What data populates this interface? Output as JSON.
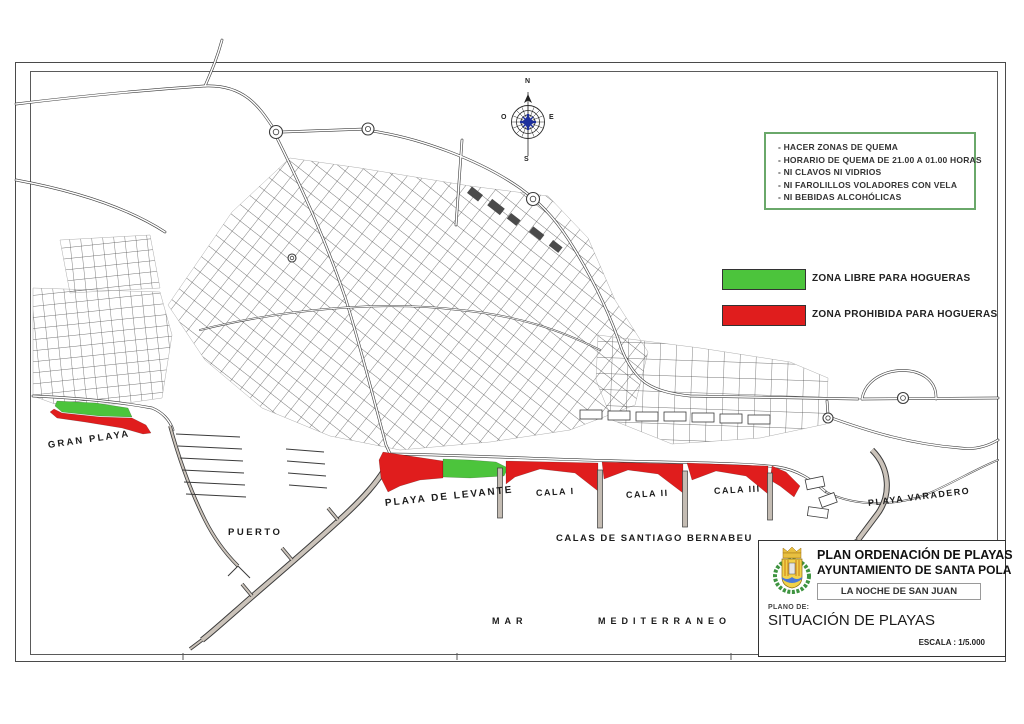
{
  "compass": {
    "north": "N",
    "south": "S",
    "east": "E",
    "west": "O"
  },
  "rules_box": {
    "items": [
      "- HACER ZONAS DE QUEMA",
      "- HORARIO DE QUEMA DE 21.00 A 01.00 HORAS",
      "- NI CLAVOS NI VIDRIOS",
      "- NI FAROLILLOS VOLADORES CON VELA",
      "- NI BEBIDAS ALCOHÓLICAS"
    ]
  },
  "legend": {
    "free": {
      "label": "ZONA LIBRE PARA HOGUERAS",
      "color": "#4cc43c"
    },
    "prohibited": {
      "label": "ZONA PROHIBIDA PARA HOGUERAS",
      "color": "#e01d1d"
    }
  },
  "zones": {
    "free_color": "#4cc43c",
    "prohibited_color": "#e01d1d",
    "groyne_color": "#c4bcb3"
  },
  "map_labels": {
    "gran_playa": "GRAN PLAYA",
    "puerto": "PUERTO",
    "playa_levante": "PLAYA DE LEVANTE",
    "cala_1": "CALA I",
    "cala_2": "CALA II",
    "cala_3": "CALA III",
    "calas_bernabeu": "CALAS DE SANTIAGO BERNABEU",
    "playa_varadero": "PLAYA VARADERO",
    "mar": "MAR",
    "mediterraneo": "MEDITERRANEO"
  },
  "title_block": {
    "title_line1": "PLAN ORDENACIÓN DE PLAYAS",
    "title_line2": "AYUNTAMIENTO DE SANTA POLA",
    "event": "LA NOCHE DE SAN JUAN",
    "plan_label": "PLANO DE:",
    "plan_name": "SITUACIÓN DE PLAYAS",
    "scale": "ESCALA : 1/5.000"
  }
}
